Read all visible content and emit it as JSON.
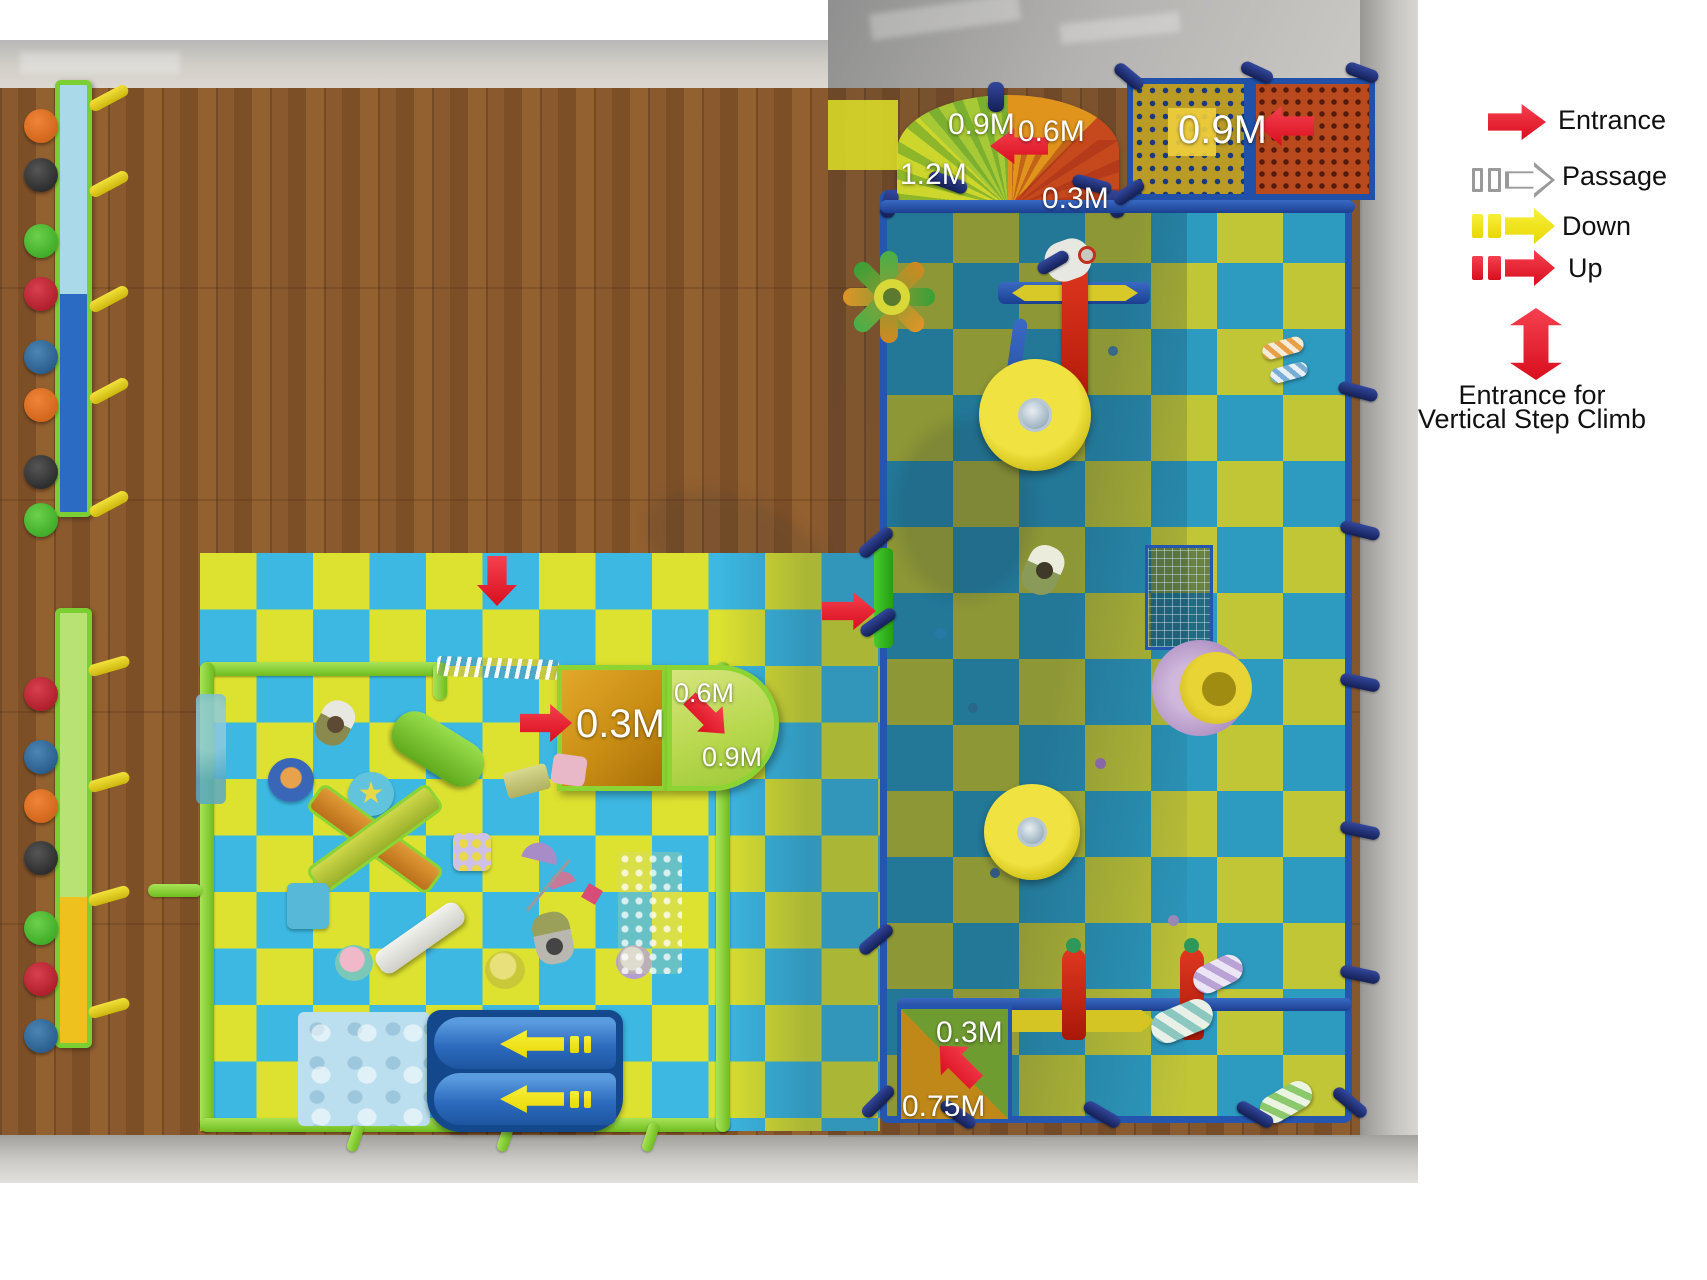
{
  "legend": {
    "entrance": {
      "label": "Entrance",
      "arrow_color": "#e21828",
      "style": "solid-right-arrow"
    },
    "passage": {
      "label": "Passage",
      "arrow_color": "#ffffff",
      "outline_color": "#9a9a9a",
      "style": "outline-right-arrow-with-dashes"
    },
    "down": {
      "label": "Down",
      "arrow_color": "#f2e60a",
      "style": "solid-right-arrow-with-dashes"
    },
    "up": {
      "label": "Up",
      "arrow_color": "#e21828",
      "style": "solid-right-arrow-with-dashes"
    },
    "vertical": {
      "label_line1": "Entrance for",
      "label_line2": "Vertical Step Climb",
      "arrow_color": "#e21828",
      "style": "double-vertical-arrow"
    }
  },
  "height_labels": {
    "arc_top": "0.9M",
    "arc_right": "0.6M",
    "arc_left": "1.2M",
    "arc_bottom": "0.3M",
    "net_panel": "0.9M",
    "toddler_entry": "0.3M",
    "toddler_step_mid": "0.6M",
    "toddler_step_corner": "0.9M",
    "south_entry_top": "0.3M",
    "south_entry_bottom": "0.75M"
  },
  "arrows": [
    {
      "id": "arc-entrance-arrow",
      "direction": "left",
      "color": "#e21828",
      "meaning": "entrance"
    },
    {
      "id": "net-entrance-arrow",
      "direction": "left",
      "color": "#e21828",
      "meaning": "entrance"
    },
    {
      "id": "toddler-top-entrance-arrow",
      "direction": "down",
      "color": "#e21828",
      "meaning": "entrance"
    },
    {
      "id": "toddler-gate-entrance-arrow",
      "direction": "right",
      "color": "#e21828",
      "meaning": "entrance"
    },
    {
      "id": "toddler-box-entrance-arrow",
      "direction": "right",
      "color": "#e21828",
      "meaning": "entrance"
    },
    {
      "id": "toddler-step-up-arrow",
      "direction": "down-right",
      "color": "#e21828",
      "meaning": "up"
    },
    {
      "id": "south-entrance-arrow",
      "direction": "down-left",
      "color": "#e21828",
      "meaning": "entrance"
    },
    {
      "id": "slide-down-arrow-1",
      "direction": "left",
      "color": "#f2e60a",
      "meaning": "down"
    },
    {
      "id": "slide-down-arrow-2",
      "direction": "left",
      "color": "#f2e60a",
      "meaning": "down"
    }
  ],
  "colors": {
    "mat_left_cyan": "#3cb8e2",
    "mat_left_yellow": "#dde230",
    "mat_right_teal": "#2d9abf",
    "mat_right_olive": "#c1c637",
    "fence_green": "#6fbc1f",
    "frame_navy": "#2456b0",
    "wood_floor": "#8a5a2e",
    "wall_grey": "#c4c2be",
    "arrow_red": "#e21828",
    "arrow_yellow": "#f2e60a"
  }
}
